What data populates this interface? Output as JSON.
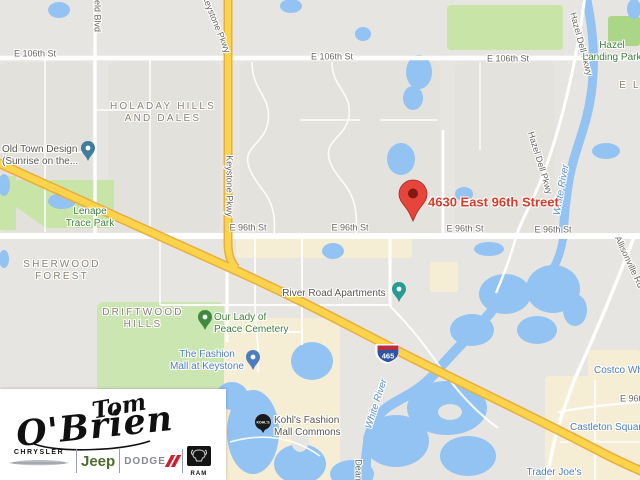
{
  "map": {
    "marker": {
      "label": "4630 East 96th Street"
    },
    "shield_text": "465",
    "street_labels": [
      {
        "t": "E 106th St",
        "x": 35,
        "y": 54
      },
      {
        "t": "E 106th St",
        "x": 332,
        "y": 57
      },
      {
        "t": "E 106th St",
        "x": 508,
        "y": 59
      },
      {
        "t": "E 96th St",
        "x": 248,
        "y": 228
      },
      {
        "t": "E 96th St",
        "x": 350,
        "y": 228
      },
      {
        "t": "E 96th St",
        "x": 465,
        "y": 229
      },
      {
        "t": "E 96th St",
        "lx": 620,
        "y": 399
      },
      {
        "t": "E 96th St",
        "x": 553,
        "y": 230
      },
      {
        "t": "Keystone Pkwy",
        "x": 216,
        "y": 24,
        "rot": 68
      },
      {
        "t": "Keystone Pkwy",
        "x": 229,
        "y": 186,
        "rot": 90
      },
      {
        "t": "Hazel Dell Pkwy",
        "x": 581,
        "y": 44,
        "rot": 75
      },
      {
        "t": "Hazel Dell Pkwy",
        "x": 540,
        "y": 163,
        "rot": 73
      },
      {
        "t": "Allisonville Rd",
        "x": 629,
        "y": 262,
        "rot": 65
      },
      {
        "t": "eld Blvd",
        "x": 97,
        "y": 16,
        "rot": 90
      },
      {
        "t": "Dean",
        "x": 358,
        "y": 470,
        "rot": 90
      }
    ],
    "neighborhood_labels": [
      {
        "lines": [
          "HOLADAY HILLS",
          "AND DALES"
        ],
        "x": 163,
        "y": 113
      },
      {
        "lines": [
          "SHERWOOD",
          "FOREST"
        ],
        "x": 62,
        "y": 271
      },
      {
        "lines": [
          "DRIFTWOOD",
          "HILLS"
        ],
        "x": 143,
        "y": 319
      },
      {
        "lines": [
          "E L"
        ],
        "x": 630,
        "y": 86
      }
    ],
    "park_labels": [
      {
        "lines": [
          "Hazel",
          "Landing Park"
        ],
        "x": 612,
        "y": 52
      },
      {
        "lines": [
          "Lenape",
          "Trace Park"
        ],
        "x": 90,
        "y": 218
      }
    ],
    "water_labels": [
      {
        "t": "White River",
        "x": 562,
        "y": 190,
        "rot": -80
      },
      {
        "t": "White River",
        "x": 377,
        "y": 404,
        "rot": -72
      }
    ],
    "poi_labels": [
      {
        "lines": [
          "Old Town Design",
          "(Sunrise on the..."
        ],
        "lx": 2,
        "y": 156,
        "style": "dark left"
      },
      {
        "lines": [
          "River Road Apartments"
        ],
        "x": 334,
        "y": 294,
        "style": "dark"
      },
      {
        "lines": [
          "Our Lady of",
          "Peace Cemetery"
        ],
        "lx": 214,
        "y": 324,
        "style": "green"
      },
      {
        "lines": [
          "The Fashion",
          "Mall at Keystone"
        ],
        "x": 207,
        "y": 361,
        "style": "shop"
      },
      {
        "lines": [
          "Kohl's Fashion",
          "Mall Commons"
        ],
        "lx": 274,
        "y": 427,
        "style": "dark left"
      },
      {
        "lines": [
          "Castleton Square"
        ],
        "lx": 570,
        "y": 428,
        "style": "shop"
      },
      {
        "lines": [
          "Costco Wholesale"
        ],
        "lx": 594,
        "y": 371,
        "style": "shop"
      },
      {
        "lines": [
          "Trader Joe's"
        ],
        "x": 554,
        "y": 473,
        "style": "shop"
      }
    ]
  },
  "logo": {
    "script_top": "Tom",
    "script_bottom": "O'Brien",
    "brands": {
      "chrysler": "CHRYSLER",
      "jeep": "Jeep",
      "dodge": "DODGE",
      "ram": "RAM"
    }
  },
  "colors": {
    "map_background": "#e7e5e1",
    "water": "#93c3f2",
    "park_green": "#c8e4a6",
    "highway_yellow": "#fbd44c",
    "marker_red": "#e7453c",
    "marker_label_red": "#db3a2b",
    "shopping_poi_blue": "#4c7dbf",
    "park_label_green": "#3f7f3c",
    "jeep_green": "#4f6b2d",
    "dodge_red": "#ce2030",
    "interstate_blue": "#2e55a3",
    "interstate_red": "#be2c3c"
  }
}
